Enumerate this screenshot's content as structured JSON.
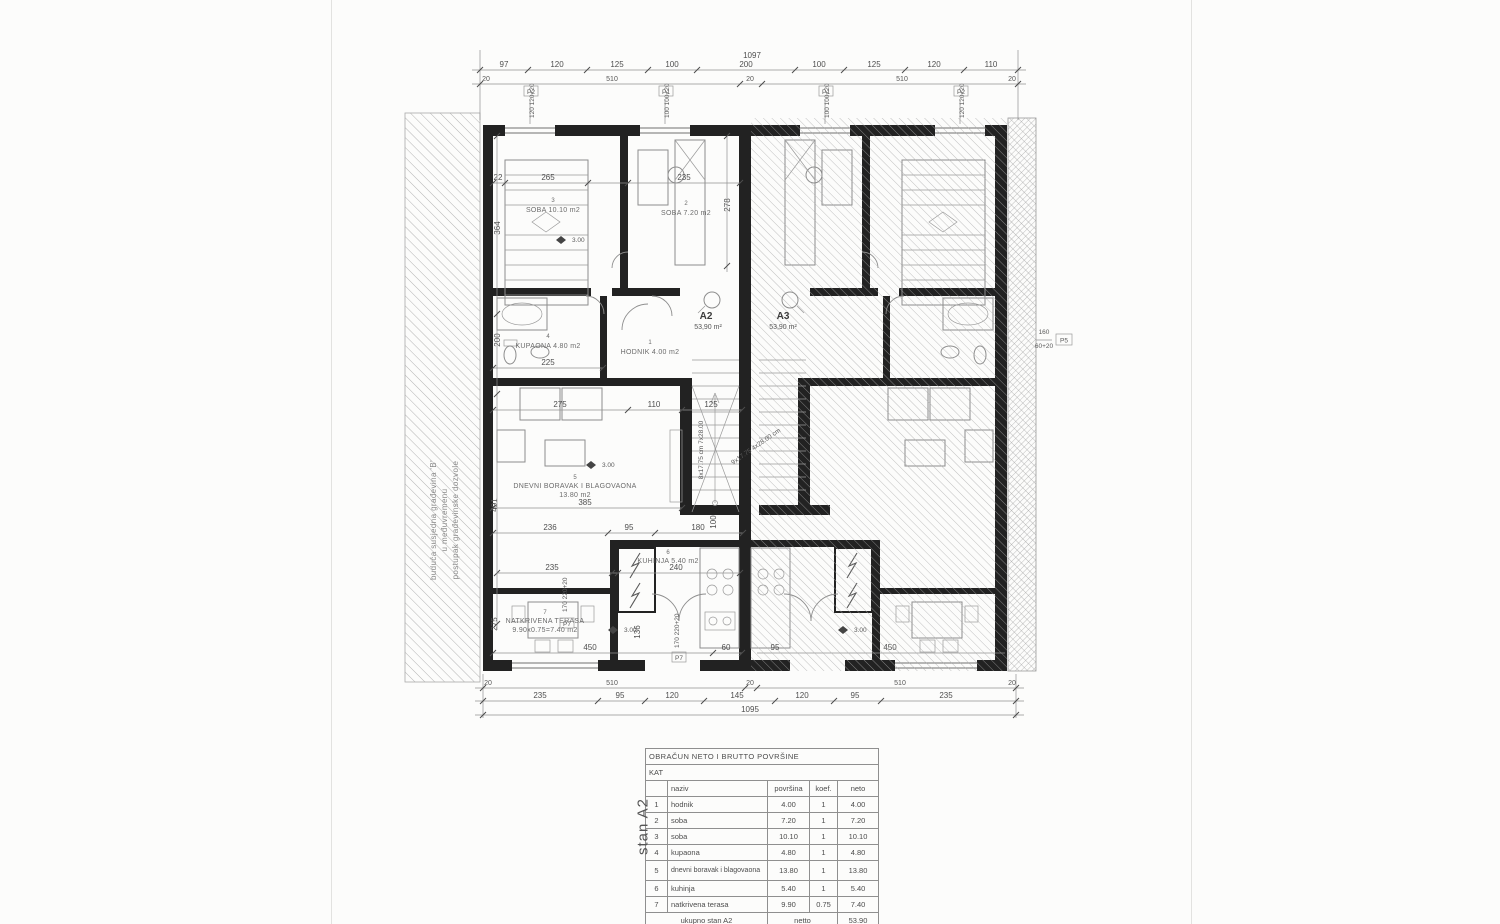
{
  "scan": {
    "neighbor_note": {
      "line1": "buduća susjedna građevina 'B'",
      "line2": "u međuvremenu",
      "line3": "postupak građevinske dozvole"
    },
    "side_label": "stan A2"
  },
  "plan": {
    "units": {
      "a2": {
        "name": "A2",
        "area": "53,90 m²"
      },
      "a3": {
        "name": "A3",
        "area": "53,90 m²"
      }
    },
    "rooms": {
      "r1": {
        "num": "1",
        "label": "HODNIK 4.00 m2"
      },
      "r2": {
        "num": "2",
        "label": "SOBA 7.20 m2"
      },
      "r3": {
        "num": "3",
        "label": "SOBA 10.10 m2"
      },
      "r4": {
        "num": "4",
        "label": "KUPAONA 4.80 m2"
      },
      "r5": {
        "num": "5",
        "label": "DNEVNI BORAVAK I BLAGOVAONA",
        "area": "13.80 m2"
      },
      "r6": {
        "num": "6",
        "label": "KUHINJA 5.40 m2"
      },
      "r7": {
        "num": "7",
        "label": "NATKRIVENA TERASA",
        "area": "9.90x0.75=7.40 m2"
      }
    },
    "stairs": {
      "note_vertical": "8x17.75 cm 7x28.00",
      "note_diagonal": "9x17.75 4x28.00 cm"
    },
    "level_mark": "3.00",
    "window_tags": {
      "p1": {
        "dims": "100 100+20",
        "code": "P1"
      },
      "p2": {
        "dims": "120 120+20",
        "code": "P2"
      },
      "p5": {
        "dim_a": "160",
        "dim_b": "60+20",
        "code": "P5"
      },
      "p7": {
        "dims": "170 220+20",
        "code": "P7"
      }
    }
  },
  "dims": {
    "top": {
      "overall": "1097",
      "segments": [
        "97",
        "120",
        "125",
        "100",
        "200",
        "100",
        "125",
        "120",
        "110"
      ],
      "group_left": "510",
      "group_right": "510",
      "center": "20",
      "edge_left": "20",
      "edge_right": "20"
    },
    "bottom": {
      "overall": "1095",
      "segments": [
        "235",
        "95",
        "120",
        "145",
        "120",
        "95",
        "235"
      ],
      "group_left": "510",
      "group_right": "510",
      "center": "20",
      "edge_left": "20",
      "edge_right": "20"
    },
    "misc": [
      "265",
      "22",
      "235",
      "364",
      "278",
      "225",
      "200",
      "275",
      "110",
      "125",
      "385",
      "236",
      "95",
      "180",
      "100",
      "235",
      "240",
      "491",
      "275",
      "450",
      "136",
      "60",
      "95",
      "450"
    ]
  },
  "table": {
    "title": "OBRAČUN NETO I BRUTTO POVRŠINE",
    "subtitle": "KAT",
    "headers": {
      "name": "naziv",
      "area": "površina",
      "coef": "koef.",
      "net": "neto"
    },
    "rows": [
      {
        "n": "1",
        "name": "hodnik",
        "area": "4.00",
        "coef": "1",
        "net": "4.00"
      },
      {
        "n": "2",
        "name": "soba",
        "area": "7.20",
        "coef": "1",
        "net": "7.20"
      },
      {
        "n": "3",
        "name": "soba",
        "area": "10.10",
        "coef": "1",
        "net": "10.10"
      },
      {
        "n": "4",
        "name": "kupaona",
        "area": "4.80",
        "coef": "1",
        "net": "4.80"
      },
      {
        "n": "5",
        "name": "dnevni boravak i blagovaona",
        "area": "13.80",
        "coef": "1",
        "net": "13.80"
      },
      {
        "n": "6",
        "name": "kuhinja",
        "area": "5.40",
        "coef": "1",
        "net": "5.40"
      },
      {
        "n": "7",
        "name": "natkrivena terasa",
        "area": "9.90",
        "coef": "0.75",
        "net": "7.40"
      }
    ],
    "footer": {
      "label": "ukupno stan A2",
      "mid": "netto",
      "value": "53.90"
    }
  }
}
